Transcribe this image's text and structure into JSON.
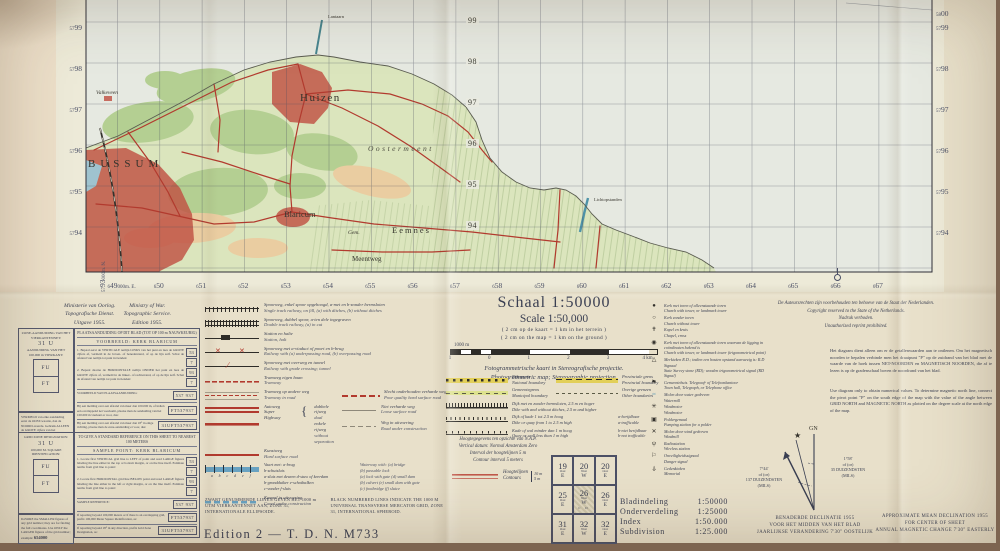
{
  "colors": {
    "paper": "#e8e0ca",
    "map_land": "#dbe5bd",
    "map_water": "#e6e9e1",
    "woods": "#b4cf92",
    "heath": "#eacda1",
    "urban_red": "#c05043",
    "road_red": "#b23a2e",
    "rail_black": "#33312c",
    "water_blue": "#4f93b4",
    "boundary_yellow": "#e2cf58",
    "contour_red": "#c0584a",
    "ink": "#3a3f52"
  },
  "map": {
    "margin": {
      "left": [
        {
          "s": "57",
          "b": "99"
        },
        {
          "s": "57",
          "b": "98"
        },
        {
          "s": "57",
          "b": "97"
        },
        {
          "s": "57",
          "b": "96"
        },
        {
          "s": "57",
          "b": "95"
        },
        {
          "s": "57",
          "b": "94"
        }
      ],
      "left_corner": {
        "s": "57",
        "b": "93",
        "suffix": "000m. N."
      },
      "right": [
        {
          "s": "57",
          "b": "99"
        },
        {
          "s": "57",
          "b": "98"
        },
        {
          "s": "57",
          "b": "97"
        },
        {
          "s": "57",
          "b": "96"
        },
        {
          "s": "57",
          "b": "95"
        },
        {
          "s": "57",
          "b": "94"
        }
      ],
      "top_right": {
        "s": "58",
        "b": "00"
      },
      "inner": [
        "99",
        "98",
        "97",
        "96",
        "95",
        "94"
      ],
      "bottom": [
        {
          "s": "6",
          "b": "49",
          "suffix": "000m. E."
        },
        {
          "s": "6",
          "b": "50"
        },
        {
          "s": "6",
          "b": "51"
        },
        {
          "s": "6",
          "b": "52"
        },
        {
          "s": "6",
          "b": "53"
        },
        {
          "s": "6",
          "b": "54"
        },
        {
          "s": "6",
          "b": "55"
        },
        {
          "s": "6",
          "b": "56"
        },
        {
          "s": "6",
          "b": "57"
        },
        {
          "s": "6",
          "b": "58"
        },
        {
          "s": "6",
          "b": "59"
        },
        {
          "s": "6",
          "b": "60"
        },
        {
          "s": "6",
          "b": "61"
        },
        {
          "s": "6",
          "b": "62"
        },
        {
          "s": "6",
          "b": "63"
        },
        {
          "s": "6",
          "b": "64"
        },
        {
          "s": "6",
          "b": "65"
        },
        {
          "s": "6",
          "b": "66"
        },
        {
          "s": "6",
          "b": "67"
        }
      ]
    },
    "labels": [
      {
        "text": "Huizen",
        "x": 300,
        "y": 101,
        "c": "lbl-town-lg"
      },
      {
        "text": "BUSSUM",
        "x": 88,
        "y": 167,
        "c": "lbl-city"
      },
      {
        "text": "Oostermeent",
        "x": 368,
        "y": 151,
        "c": "lbl-area"
      },
      {
        "text": "Blaricum",
        "x": 284,
        "y": 217,
        "c": "lbl-town"
      },
      {
        "text": "Gem.",
        "x": 348,
        "y": 234,
        "c": "lbl-small-i"
      },
      {
        "text": "Eemnes",
        "x": 392,
        "y": 233,
        "c": "lbl-town-sp"
      },
      {
        "text": "Meentweg",
        "x": 352,
        "y": 261,
        "c": "lbl-road"
      },
      {
        "text": "Valkeveen",
        "x": 96,
        "y": 94,
        "c": "lbl-small-i"
      },
      {
        "text": "Lantaarn",
        "x": 328,
        "y": 18,
        "c": "lbl-tiny"
      },
      {
        "text": "Lichtopstanden",
        "x": 594,
        "y": 201,
        "c": "lbl-tiny"
      }
    ]
  },
  "publisher": {
    "nl": [
      "Ministerie van Oorlog.",
      "Topografische Dienst.",
      "Uitgave 1955."
    ],
    "en": [
      "Ministry of War.",
      "Topographic Service.",
      "Edition 1955."
    ]
  },
  "grid_ref_nl": {
    "zone_title": "ZONE-AANDUIDING VAN HET VIERKANTENNET:",
    "zone_value": "31 U",
    "square_title": "AANDUIDING VAN HET 100.000 m VIERKANT:",
    "square_top": "FU",
    "square_bottom": "FT",
    "footer": "VERMELD van elke aanduiding eerst de OOST-waarde, dan de NOORD-waarde. Gebruik ALLEEN de GROTE cijfers van het netnummer; voorbeeld:",
    "footer_example": "654000",
    "ref_title": "PLAATSAANDUIDING OP DIT BLAD (TOT OP 100 m NAUWKEURIG)",
    "example_label": "VOORBEELD:",
    "example_value": "KERK BLARICUM",
    "step1": "1. Bepaal eerst de VERTICALE netlijn LINKS van het punt en lees de GROTE cijfers af, vermeld in de boven- of benedenrand, of op de lijn zelf. Schat de afstand van netlijn tot punt in tienden:",
    "v1": "53",
    "t1": "7",
    "step2": "2. Bepaal daarna de HORIZONTALE netlijn ONDER het punt en lees de GROTE cijfers af, vermeld in de linker- of rechterrand, of op de lijn zelf. Schat de afstand van netlijn tot punt in tienden:",
    "v2": "93",
    "t2": "7",
    "sample_label": "VOORBEELD VAN PLAATSAANDUIDING:",
    "sample_value": "537 937",
    "row2": "Bij een melding over een afstand van meer dan 100.000 m, of indien een overlappend net voorkomt, plaatse men de aanduiding van het 100.000 m vierkant er voor, dus:",
    "row2_value": "FT537937",
    "row3": "Bij een melding over een afstand van meer dan 18° in enige richting, plaatse men de zone-aanduiding er voor, dus:",
    "row3_value": "31UFT537937"
  },
  "grid_ref_en": {
    "zone_title": "GRID ZONE DESIGNATION:",
    "zone_value": "31 U",
    "square_title": "100,000 M. SQUARE IDENTIFICATION:",
    "square_top": "FU",
    "square_bottom": "FT",
    "footer": "IGNORE the SMALLER figures of any grid number; they are for finding the full coordinates. Use ONLY the LARGER figures of the grid number; example:",
    "footer_example": "654000",
    "ref_title": "TO GIVE A STANDARD REFERENCE ON THIS SHEET TO NEAREST 100 METERS",
    "example_label": "SAMPLE POINT:",
    "example_value": "KERK BLARICUM",
    "step1": "1. Locate first VERTICAL grid line to LEFT of point and read LARGE figures labeling the line either in the top or bottom margin, or on the line itself. Estimate tenths from grid line to point:",
    "v1": "53",
    "t1": "7",
    "step2": "2. Locate first HORIZONTAL grid line BELOW point and read LARGE figures labeling the line either in the left or right margin, or on the line itself. Estimate tenths from grid line to point:",
    "v2": "93",
    "t2": "7",
    "sample_label": "SAMPLE REFERENCE:",
    "sample_value": "537 937",
    "row2": "If reporting beyond 100,000 meters or if there is an overlapping grid, prefix 100,000 Meter Square Identification, as:",
    "row2_value": "FT537937",
    "row3": "If reporting beyond 18° in any direction, prefix Grid Zone Designation, as:",
    "row3_value": "31UFT537937"
  },
  "center_rows": [
    {
      "t": "row",
      "sym": "rail-single",
      "nl": "Spoorweg, enkel spoor opgehoogd, a-met en b-zonder bermsloten",
      "en": "Single track railway, on fill, (a) with ditches, (b) without ditches"
    },
    {
      "t": "row",
      "sym": "rail-double",
      "nl": "Spoorweg, dubbel spoor, a-ten dele ingegraven",
      "en": "Double track railway, (a) in cut"
    },
    {
      "t": "row",
      "sym": "station",
      "nl": "Station en halte",
      "en": "Station, halt"
    },
    {
      "t": "row",
      "sym": "rail-viaduct",
      "nl": "Spoorweg met a-viaduct of poort en b-brug",
      "en": "Railway with (a) underpassing road, (b) overpassing road"
    },
    {
      "t": "row",
      "sym": "rail-crossing",
      "nl": "Spoorweg met overweg en tunnel",
      "en": "Railway with grade crossing; tunnel"
    },
    {
      "t": "row",
      "sym": "tram-own",
      "nl": "Tramweg eigen baan",
      "en": "Tramway"
    },
    {
      "t": "row2",
      "sym": "tram-road",
      "nl": "Tramweg op andere weg",
      "en": "Tramway in road",
      "rsym": "poor-road",
      "rnl": "Slecht onderhouden verharde weg",
      "ren": "Poor quality hard surface road"
    },
    {
      "t": "highway"
    },
    {
      "t": "row",
      "sym": "hard-road",
      "nl": "Kunstweg",
      "en": "Hard surface road"
    },
    {
      "t": "waterway"
    },
    {
      "t": "row",
      "sym": "canal-constr",
      "nl": "Kanaal in uitvoering",
      "en": "Canal under construction"
    }
  ],
  "highway": {
    "nl": "Autoweg",
    "en1": "Super",
    "en2": "Highway",
    "sub1_nl": "dubbele rijweg",
    "sub1_en": "dual",
    "sub2_nl": "enkele rijweg",
    "sub2_en": "without separation",
    "r1nl": "Niet verharde weg",
    "r1en": "Loose surface road",
    "r2nl": "Weg in uitvoering",
    "r2en": "Road under construction"
  },
  "waterway": {
    "head_nl": "Vaart met:  a-brug",
    "head_en": "Waterway with: (a) bridge",
    "head_nl2": "b-schutsluis",
    "head_en2": "(b) passable lock",
    "l2nl": "a-sluis met deuren   d-stuw of keerdam",
    "l2en": "(a) lock with gate   (d) small dam",
    "l3nl": "b-grondduiker   e-schotbalken",
    "l3en": "(b) culvert   (e) small dam with gate",
    "l4nl": "c-vonder   f-sluis",
    "l4en": "(c) footbridge   (f) sluice",
    "letters": "a b c d e f"
  },
  "utm_note": {
    "nl": "ZWART GENUMMERDE LIJNEN GEVEN HET 1000 m UTM VIERKANTENNET AAN, ZONE 31, INTERNATIONALE ELLIPSOIDE.",
    "en": "BLACK NUMBERED LINES INDICATE THE 1000 M UNIVERSAL TRANSVERSE MERCATOR GRID, ZONE 31, INTERNATIONAL SPHEROID."
  },
  "edition_line": "Edition 2  —  T. D. N.  M733",
  "scale_block": {
    "title": "Schaal 1:50000",
    "subtitle": "Scale 1:50,000",
    "note_nl": "( 2 cm op de kaart = 1 km in het terrein )",
    "note_en": "( 2 cm on the map = 1 km on the ground )",
    "bar_label": "1000 m",
    "bar_ticks": [
      "1",
      "0",
      "1",
      "2",
      "3",
      "4 km"
    ],
    "proj_nl": "Fotogrammetrische kaart in Stereografische projectie.",
    "proj_en": "Photogrammetric map; Stereographic projection."
  },
  "boundary_rows": [
    {
      "t": "pair",
      "sym": "national",
      "nl": "Rijksgrens",
      "en": "National boundary",
      "rsym": "provincial",
      "rnl": "Provinciale grens",
      "ren": "Provincial boundary"
    },
    {
      "t": "pair",
      "sym": "municipal",
      "nl": "Gemeentegrens",
      "en": "Municipal boundary",
      "rsym": "other",
      "rnl": "Overige grenzen",
      "ren": "Other boundaries"
    },
    {
      "t": "full",
      "sym": "dike-high",
      "nl": "Dijk met en zonder bermsloten, 2.5 m en hoger",
      "en": "Dike with and without ditches, 2.5 m and higher"
    },
    {
      "t": "full",
      "sym": "dike-mid",
      "nl": "Dijk of kade 1 tot 2.5 m hoog",
      "en": "Dike or quay from 1 to 2.5 m high",
      "rnl": "a-berijdbaar",
      "ren": "a-trafficable"
    },
    {
      "t": "full",
      "sym": "quay-low",
      "nl": "Kade of wal minder dan 1 m hoog",
      "en": "Quay or wall less than 1 m high",
      "rnl": "b-niet berijdbaar",
      "ren": "b-not trafficable"
    }
  ],
  "nap": [
    "Hoogtegegevens ten opzichte van N.A.P.",
    "Vertical datum: Normal Amsterdam Zero",
    "Interval der hoogtelijnen 5 m",
    "Contour interval 5 meters"
  ],
  "contours": {
    "nl": "Hoogtelijnen",
    "en": "Contours",
    "v1": "10 m",
    "v2": "5 m"
  },
  "sheet_index": {
    "cells": [
      {
        "n": "19",
        "d": "Oost",
        "l": "E"
      },
      {
        "n": "20",
        "d": "West",
        "l": "W"
      },
      {
        "n": "20",
        "d": "Oost",
        "l": "E"
      },
      {
        "n": "25",
        "d": "Oost",
        "l": "E"
      },
      {
        "n": "26",
        "d": "West",
        "l": "W"
      },
      {
        "n": "26",
        "d": "Oost",
        "l": "E"
      },
      {
        "n": "31",
        "d": "Oost",
        "l": "E"
      },
      {
        "n": "32",
        "d": "West",
        "l": "W"
      },
      {
        "n": "32",
        "d": "Oost",
        "l": "E"
      }
    ],
    "center_sub": "C D"
  },
  "index_labels": [
    {
      "k": "Bladindeling",
      "v": "1:50000"
    },
    {
      "k": "Onderverdeling",
      "v": "1:25000"
    },
    {
      "k": "Index",
      "v": "1:50.000"
    },
    {
      "k": "Subdivision",
      "v": "1:25.000"
    }
  ],
  "symbol_rows": [
    {
      "icon": "church-tower-icon",
      "glyph": "●",
      "nl": "Kerk met toren of alleenstaande toren",
      "en": "Church with tower, or landmark tower"
    },
    {
      "icon": "church-no-tower-icon",
      "glyph": "○",
      "nl": "Kerk zonder toren",
      "en": "Church without tower"
    },
    {
      "icon": "chapel-cross-icon",
      "glyph": "✝",
      "nl": "Kapel en kruis",
      "en": "Chapel, cross"
    },
    {
      "icon": "church-trig-icon",
      "glyph": "◉",
      "nl": "Kerk met toren of alleenstaande toren waarvan de ligging in coördinaten bekend is",
      "en": "Church with tower, or landmark tower (trigonometrical point)"
    },
    {
      "icon": "rd-stone-icon",
      "glyph": "△",
      "nl": "Merkteken R.D.; indien een houten opstand aanwezig is: R.D Signaal",
      "en": "State Survey stone (RD); wooden trigonometrical signal (RD Signal)"
    },
    {
      "icon": "town-hall-icon",
      "glyph": "⚑",
      "nl": "Gemeentehuis. Telegraaf- of Telefoonkantoor",
      "en": "Town hall, Telegraph, or Telephone office"
    },
    {
      "icon": "watermill-icon",
      "glyph": "≈",
      "nl": "Molen door water gedreven",
      "en": "Watermill"
    },
    {
      "icon": "windmotor-icon",
      "glyph": "✳",
      "nl": "Windmotor",
      "en": "Windmotor"
    },
    {
      "icon": "pumping-station-icon",
      "glyph": "▣",
      "nl": "Poldergemaal",
      "en": "Pumping station for a polder"
    },
    {
      "icon": "windmill-icon",
      "glyph": "✕",
      "nl": "Molen door wind gedreven",
      "en": "Windmill"
    },
    {
      "icon": "radio-station-icon",
      "glyph": "ψ",
      "nl": "Radiostation",
      "en": "Wireless station"
    },
    {
      "icon": "danger-signal-icon",
      "glyph": "⚐",
      "nl": "Onveiligheidssignaal",
      "en": "Danger signal"
    },
    {
      "icon": "memorial-icon",
      "glyph": "⍙",
      "nl": "Gedenkteken",
      "en": "Memorial"
    }
  ],
  "copyright": [
    "De Auteursrechten zijn voorbehouden ten behoeve van de Staat der Nederlanden.",
    "Copyright reserved to the State of the Netherlands.",
    "Nadruk verboden.",
    "Unauthorized reprint prohibited."
  ],
  "diagram_note": {
    "nl": "Het diagram dient alleen om er de getallenwaarden aan te ontlenen. Om het magnetisch noorden te bepalen verbinde men het draaipunt \"P\" op de zuidrand van het blad met de waarde van de hoek tussen NET-NOORDEN en MAGNETISCH NOORDEN, die af te lezen is op de gradenschaal boven de noordrand van het blad.",
    "en": "Use diagram only to obtain numerical values. To determine magnetic north line, connect the pivot point \"P\" on the south edge of the map with the value of the angle between GRID NORTH and MAGNETIC NORTH as plotted on the degree scale at the north edge of the map."
  },
  "declination": {
    "gn": "GN",
    "left": [
      "7°44'",
      "of (or)",
      "137 DUIZENDSTEN",
      "(MILS)"
    ],
    "right": [
      "1°58'",
      "of (or)",
      "35 DUIZENDSTEN",
      "(MILS)"
    ],
    "nl": [
      "BENADERDE DECLINATIE 1955",
      "VOOR HET MIDDEN VAN HET BLAD",
      "JAARLIJKSE VERANDERING 7'30\" OOSTELIJK"
    ],
    "en": [
      "APPROXIMATE MEAN DECLINATION 1955",
      "FOR CENTER OF SHEET",
      "ANNUAL MAGNETIC CHANGE 7'30\" EASTERLY"
    ]
  }
}
